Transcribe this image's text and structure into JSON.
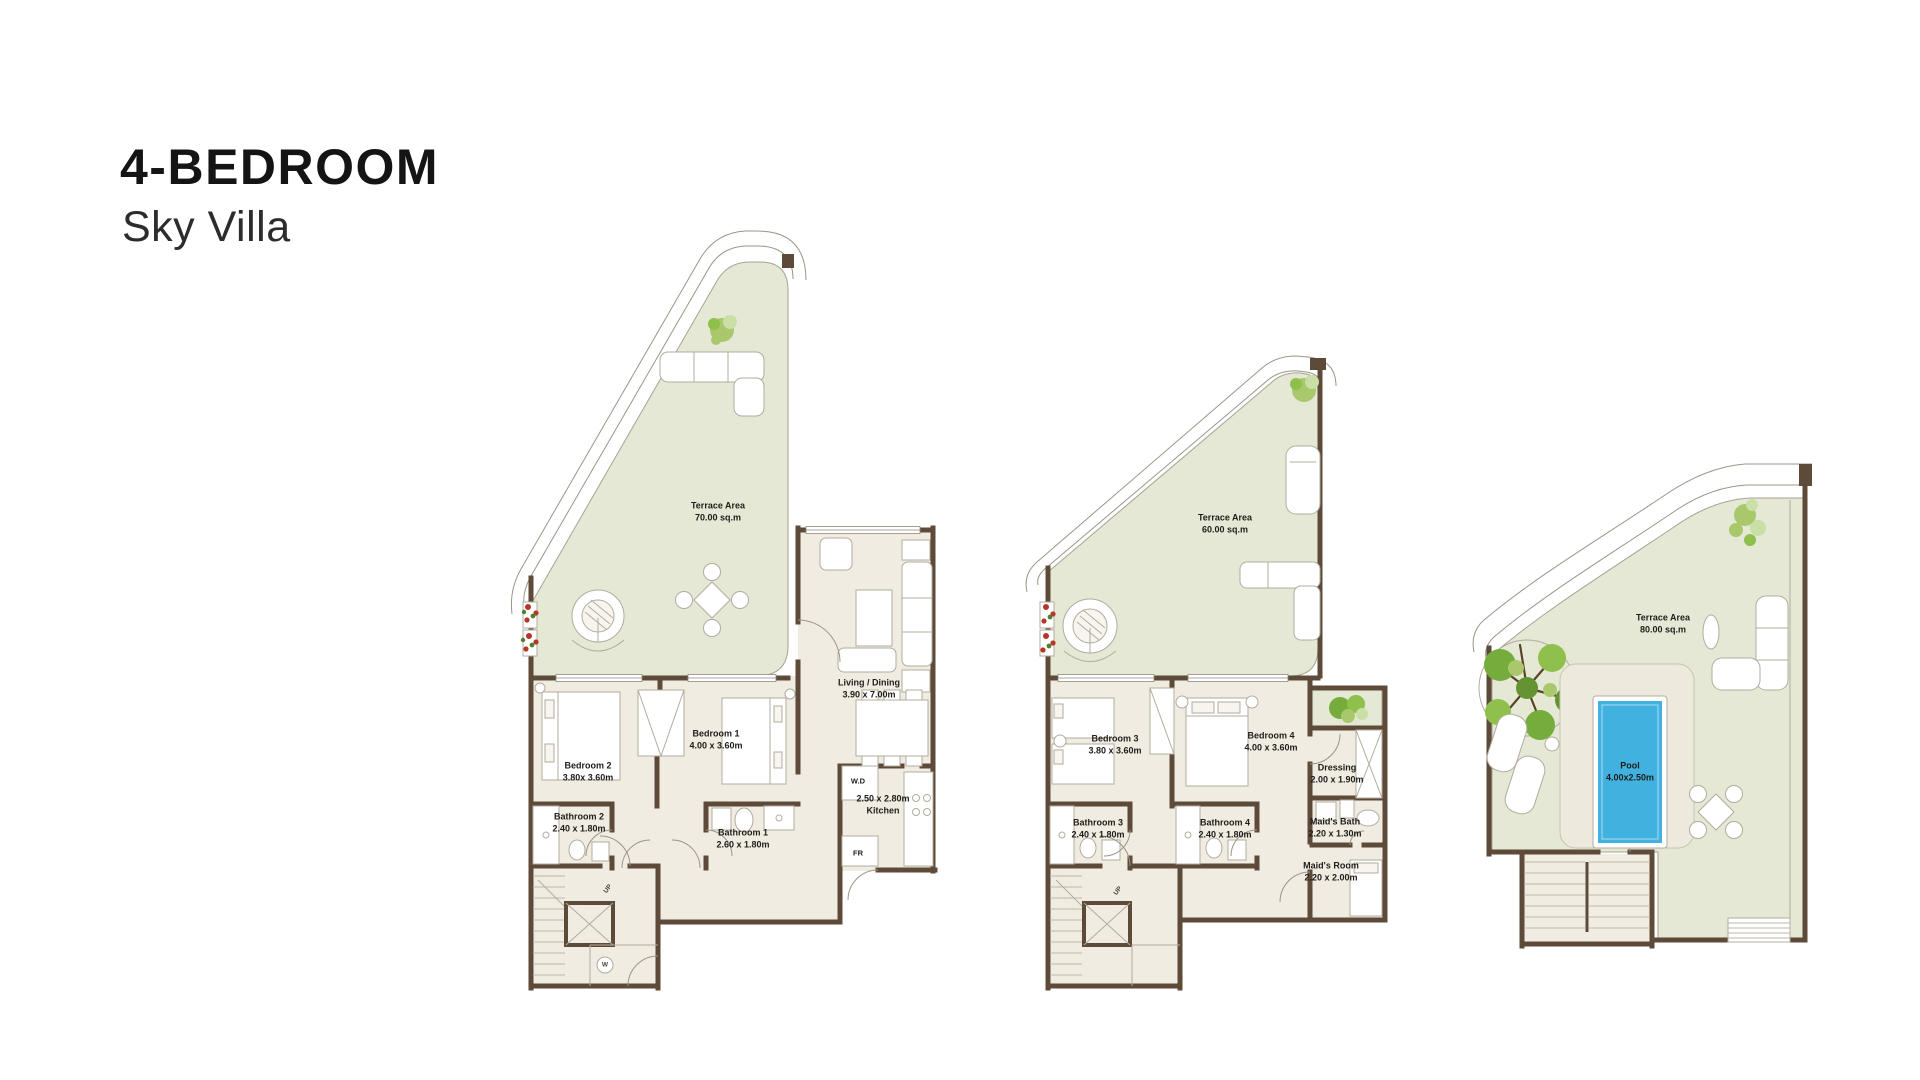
{
  "title": {
    "line1": "4-BEDROOM",
    "line2": "Sky Villa"
  },
  "colors": {
    "wall_brown": "#5d4a39",
    "terrace_green": "#e4e8d5",
    "floor_cream": "#f0ece1",
    "line_gray": "#b2ac9e",
    "pool_blue": "#41b1e0",
    "tree_green": "#76ac3c",
    "flower_red": "#b5372a",
    "label_text": "#1f1d1a"
  },
  "plans": {
    "level1": {
      "terrace": {
        "name": "Terrace Area",
        "size": "70.00 sq.m"
      },
      "bedroom2": {
        "name": "Bedroom 2",
        "size": "3.80x 3.60m"
      },
      "bedroom1": {
        "name": "Bedroom 1",
        "size": "4.00 x 3.60m"
      },
      "living_dining": {
        "name": "Living / Dining",
        "size": "3.90 x 7.00m"
      },
      "bathroom2": {
        "name": "Bathroom 2",
        "size": "2.40 x 1.80m"
      },
      "bathroom1": {
        "name": "Bathroom 1",
        "size": "2.60 x 1.80m"
      },
      "kitchen": {
        "size": "2.50 x 2.80m",
        "name": "Kitchen"
      },
      "wd_closet": "W.D",
      "fridge": "FR",
      "stairs_up": "UP",
      "washer": "W"
    },
    "level2": {
      "terrace": {
        "name": "Terrace Area",
        "size": "60.00 sq.m"
      },
      "bedroom3": {
        "name": "Bedroom 3",
        "size": "3.80 x 3.60m"
      },
      "bedroom4": {
        "name": "Bedroom 4",
        "size": "4.00 x 3.60m"
      },
      "dressing": {
        "name": "Dressing",
        "size": "2.00 x 1.90m"
      },
      "bathroom3": {
        "name": "Bathroom 3",
        "size": "2.40 x 1.80m"
      },
      "bathroom4": {
        "name": "Bathroom 4",
        "size": "2.40 x 1.80m"
      },
      "maids_bath": {
        "name": "Maid's Bath",
        "size": "2.20 x 1.30m"
      },
      "maids_room": {
        "name": "Maid's Room",
        "size": "2.20 x 2.00m"
      },
      "stairs_up": "UP"
    },
    "roof": {
      "terrace": {
        "name": "Terrace Area",
        "size": "80.00 sq.m"
      },
      "pool": {
        "name": "Pool",
        "size": "4.00x2.50m"
      }
    }
  }
}
